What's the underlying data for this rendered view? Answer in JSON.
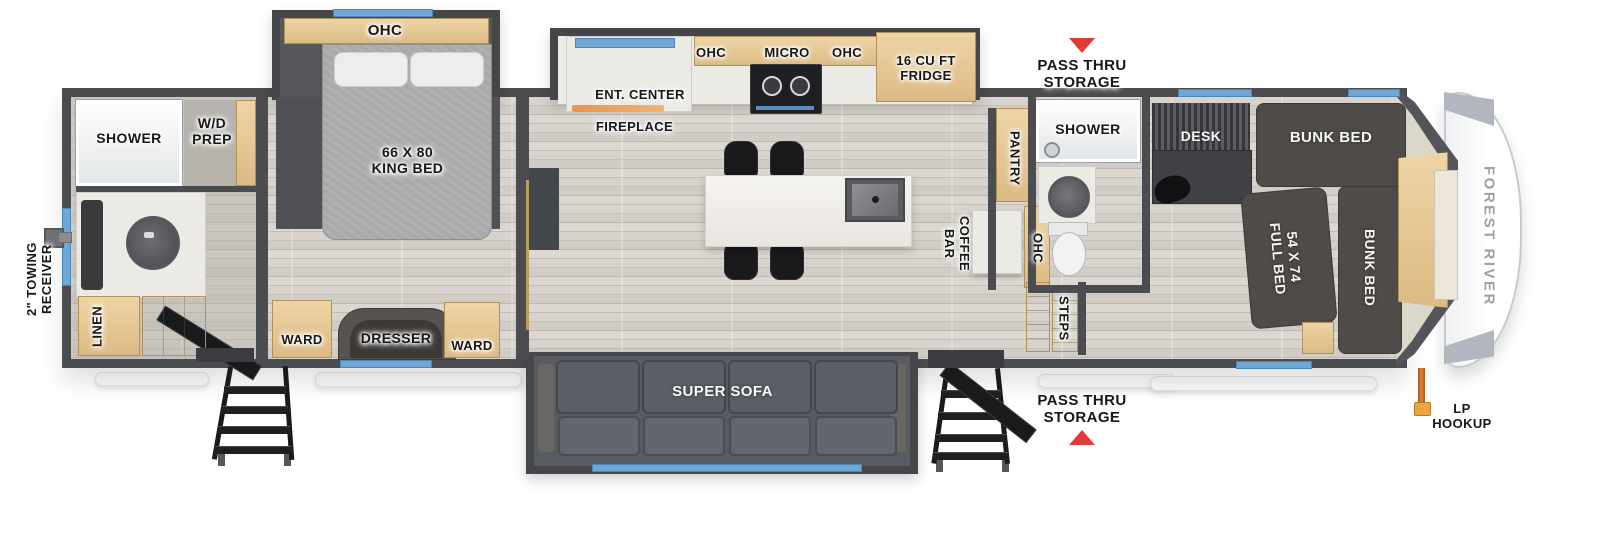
{
  "floorplan": {
    "front": {
      "brand": "FOREST RIVER"
    },
    "exterior": {
      "towing_receiver": "2\" TOWING\nRECEIVER",
      "pass_thru_top": "PASS THRU\nSTORAGE",
      "pass_thru_bottom": "PASS THRU\nSTORAGE",
      "lp_hookup": "LP\nHOOKUP"
    },
    "rear_bath": {
      "shower": "SHOWER",
      "wd_prep": "W/D\nPREP",
      "linen": "LINEN"
    },
    "bedroom": {
      "ohc": "OHC",
      "king_bed": "66 X 80\nKING BED",
      "ward_left": "WARD",
      "dresser": "DRESSER",
      "ward_right": "WARD"
    },
    "kitchen": {
      "ent_center": "ENT. CENTER",
      "fireplace": "FIREPLACE",
      "ohc_left": "OHC",
      "micro": "MICRO",
      "ohc_right": "OHC",
      "fridge": "16 CU FT\nFRIDGE"
    },
    "galley": {
      "pantry": "PANTRY",
      "coffee_bar": "COFFEE\nBAR",
      "ohc": "OHC",
      "steps": "STEPS"
    },
    "mid_bath": {
      "shower": "SHOWER"
    },
    "living": {
      "super_sofa": "SUPER SOFA"
    },
    "bunk_room": {
      "desk": "DESK",
      "bunk_bed_top": "BUNK BED",
      "full_bed": "54 X 74\nFULL BED",
      "bunk_bed_right": "BUNK BED"
    },
    "colors": {
      "window_blue": "#6FA8D6",
      "marker_red": "#E23B36",
      "lp_orange": "#C96A22",
      "wall_gray": "#4A4C4F",
      "cabinet_wood": "#E0C493"
    }
  }
}
